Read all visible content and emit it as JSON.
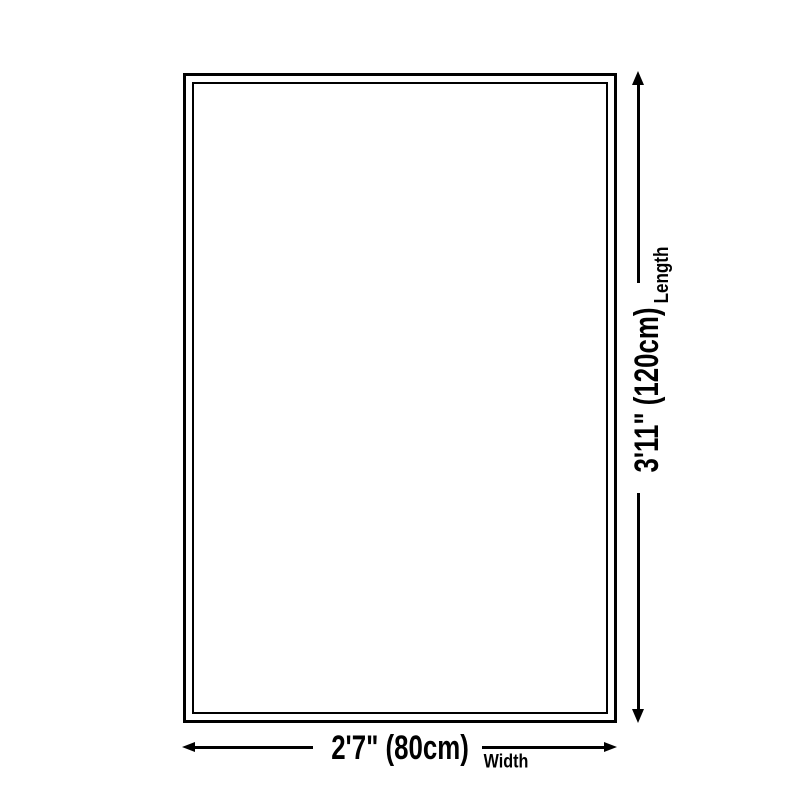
{
  "page": {
    "background_color": "#ffffff"
  },
  "diagram": {
    "type": "product-dimension-diagram",
    "line_color": "#000000",
    "text_color": "#000000",
    "length_dimension": {
      "value": "3'11\" (120cm)",
      "label": "Length"
    },
    "width_dimension": {
      "value": "2'7\" (80cm)",
      "label": "Width"
    }
  }
}
